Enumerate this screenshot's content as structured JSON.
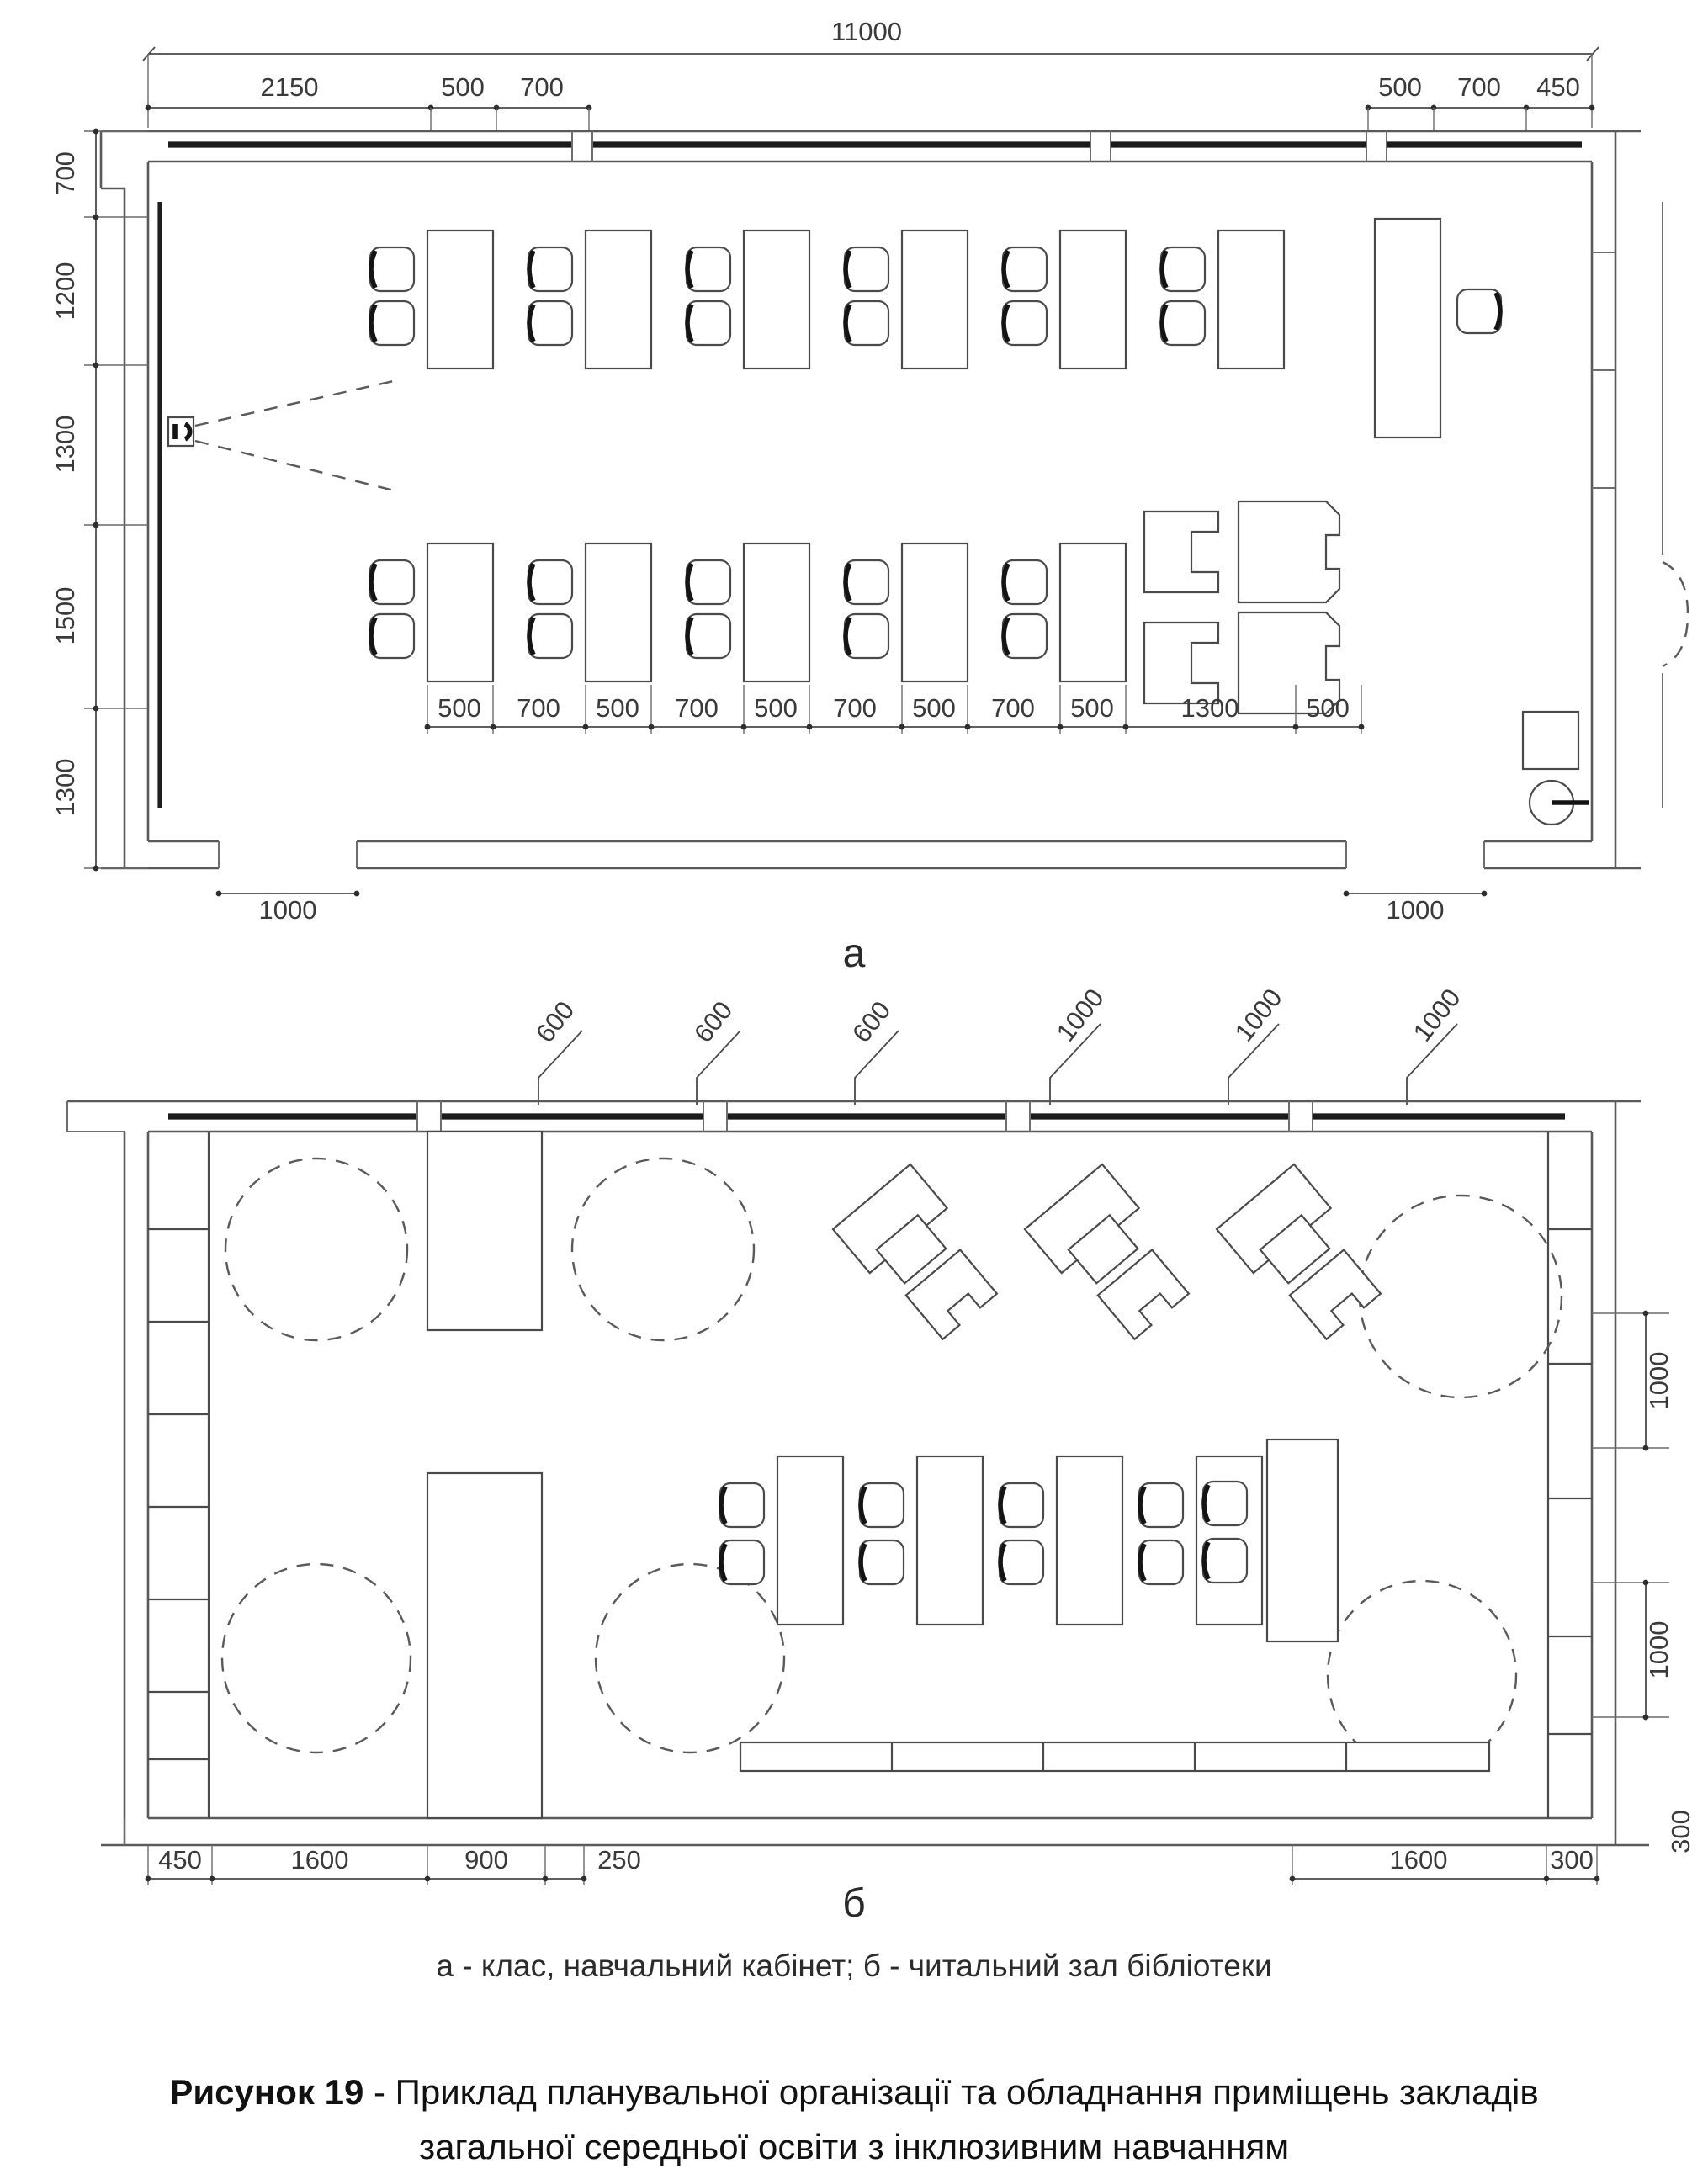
{
  "figure": {
    "plan_a_label": "а",
    "plan_b_label": "б",
    "legend": "а - клас, навчальний кабінет; б - читальний зал бібліотеки",
    "caption_title": "Рисунок 19",
    "caption_line1": " - Приклад планувальної організації та обладнання приміщень закладів",
    "caption_line2": "загальної середньої освіти з інклюзивним навчанням"
  },
  "plan_a": {
    "dim_total": "11000",
    "top_left_dims": [
      "2150",
      "500",
      "700"
    ],
    "top_right_dims": [
      "500",
      "700",
      "450"
    ],
    "left_dims": [
      "700",
      "1200",
      "1300",
      "1500",
      "1300"
    ],
    "row_dims": [
      "500",
      "700",
      "500",
      "700",
      "500",
      "700",
      "500",
      "700",
      "500",
      "1300",
      "500"
    ],
    "door_left_dim": "1000",
    "door_right_dim": "1000"
  },
  "plan_b": {
    "window_dims": [
      "600",
      "600",
      "600",
      "1000",
      "1000",
      "1000"
    ],
    "right_dims": [
      "1000",
      "1000"
    ],
    "bottom_left_dims": [
      "450",
      "1600",
      "900",
      "250"
    ],
    "bottom_right_dims": [
      "1600",
      "300"
    ],
    "side_dim": "300"
  }
}
